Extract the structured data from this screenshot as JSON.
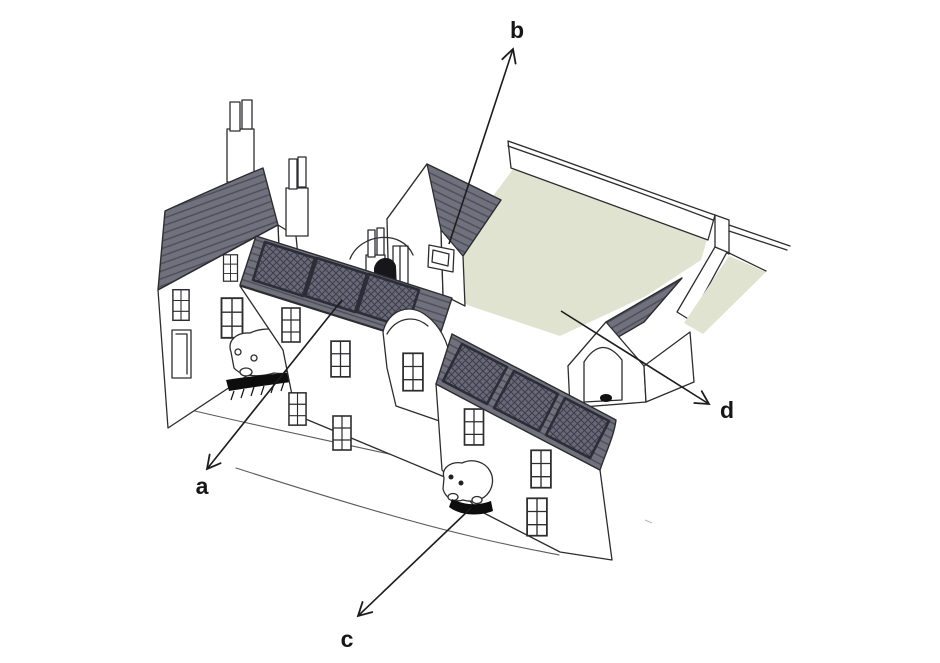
{
  "figure": {
    "background": "#ffffff",
    "colors": {
      "line": "#2d2d30",
      "roof_fill": "#71717e",
      "roof_hatch": "#4c4c59",
      "panel_fill": "#686876",
      "panel_frame": "#2c2d37",
      "panel_hatch": "#3c3d4a",
      "courtyard_green": "#dfe3cf",
      "shadow_black": "#0d0d0d",
      "label_text": "#161616"
    }
  },
  "annotations": {
    "a": {
      "label": "a",
      "target": "solar-panels-front-roof",
      "arrow": {
        "x1": 342,
        "y1": 300,
        "x2": 207,
        "y2": 469
      },
      "label_pos": {
        "x": 202,
        "y": 494
      }
    },
    "b": {
      "label": "b",
      "target": "vent-box-rear-building-wall",
      "arrow": {
        "x1": 449,
        "y1": 244,
        "x2": 513,
        "y2": 49
      },
      "label_pos": {
        "x": 517,
        "y": 38
      }
    },
    "c": {
      "label": "c",
      "target": "vehicle-at-street-level",
      "arrow": {
        "x1": 471,
        "y1": 508,
        "x2": 358,
        "y2": 616
      },
      "label_pos": {
        "x": 347,
        "y": 647
      }
    },
    "d": {
      "label": "d",
      "target": "walled-courtyard-garden",
      "arrow": {
        "x1": 561,
        "y1": 311,
        "x2": 709,
        "y2": 404
      },
      "label_pos": {
        "x": 727,
        "y": 418
      }
    }
  }
}
